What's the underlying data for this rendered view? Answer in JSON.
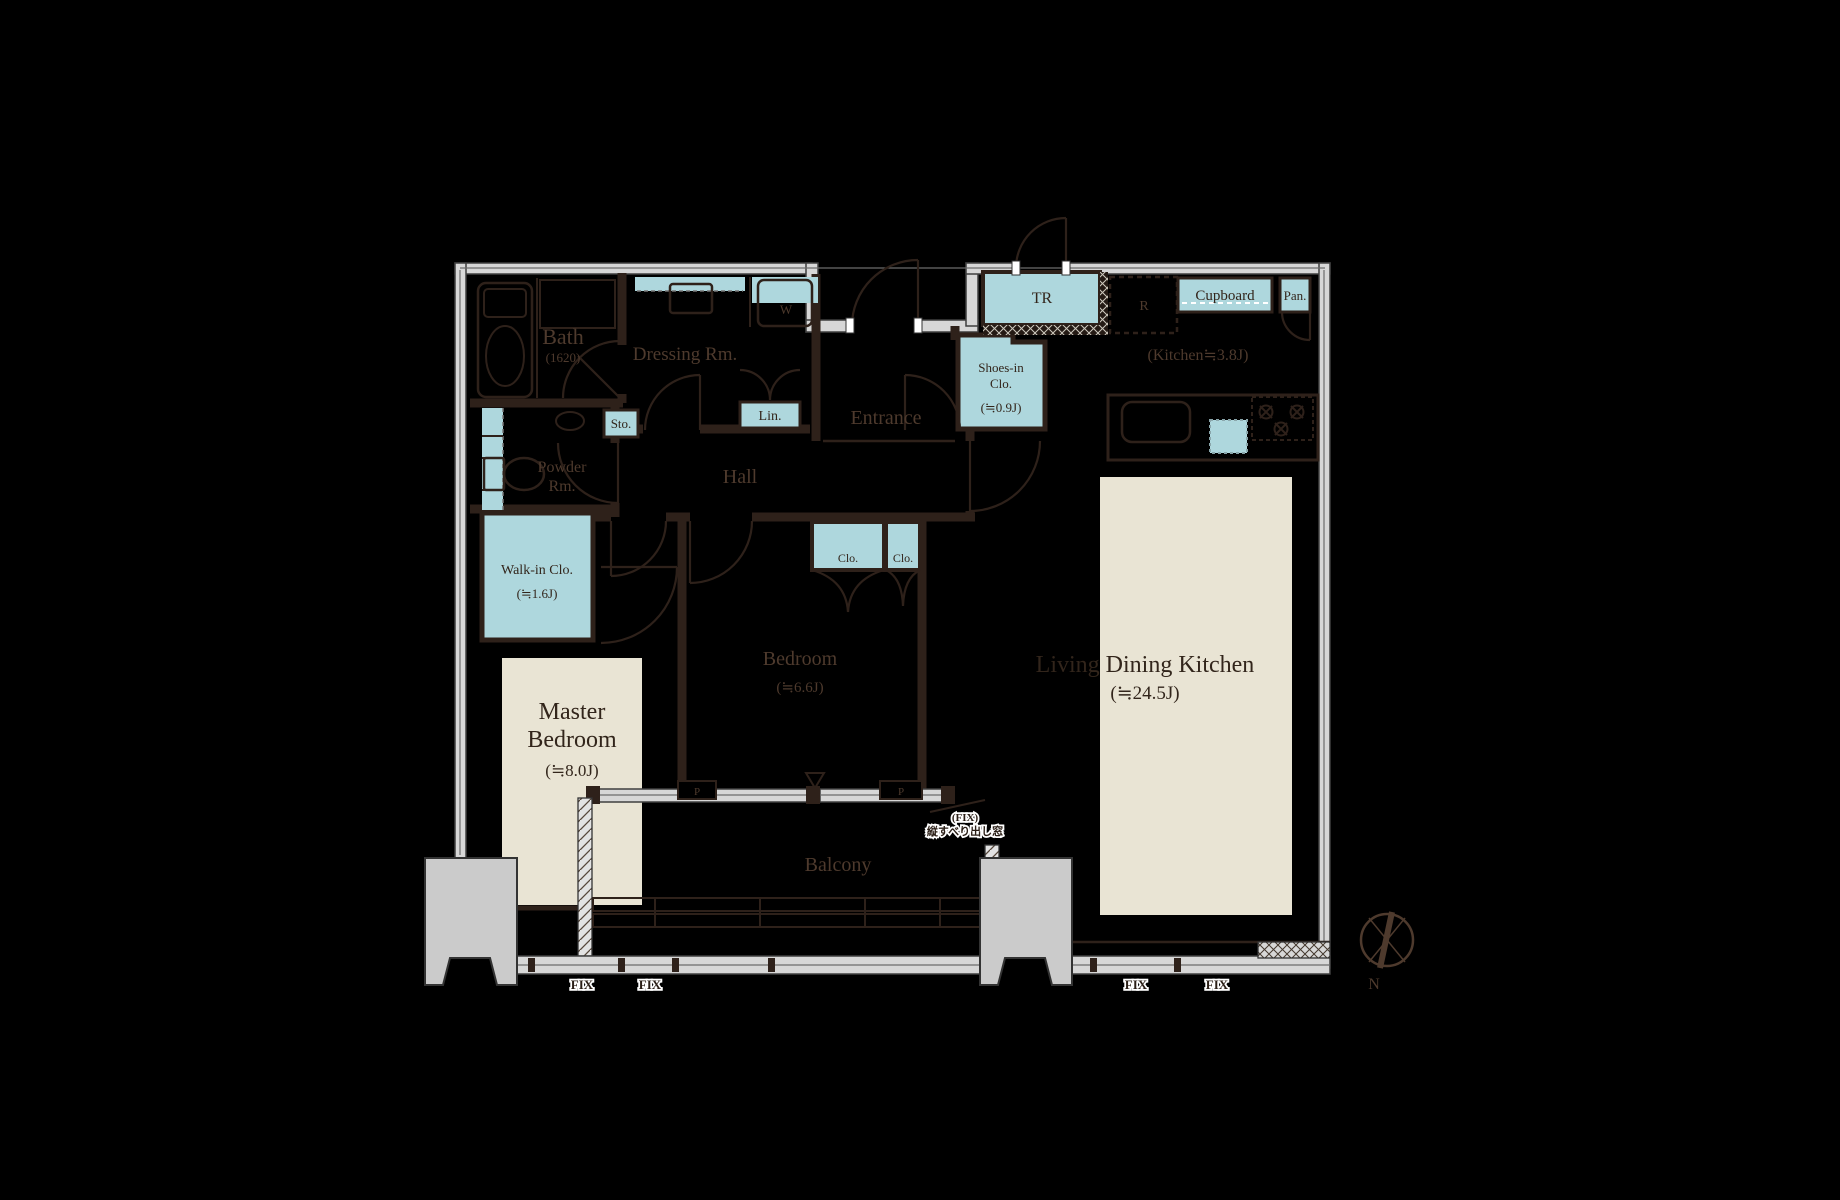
{
  "plan": {
    "colors": {
      "background": "#000000",
      "wall_brown": "#2e211a",
      "window_gray": "#d7d7d7",
      "fixture_blue": "#aed7dd",
      "rug_beige": "#e9e4d4",
      "pillar_gray": "#cbcbcb",
      "label_on_dark": "#4e3a2d",
      "label_on_light": "#32251b"
    },
    "labels": {
      "bath_name": "Bath",
      "bath_size": "(1620)",
      "dressing_room": "Dressing Rm.",
      "washer": "W",
      "entrance": "Entrance",
      "trunk_room": "TR",
      "refrigerator": "R",
      "cupboard": "Cupboard",
      "pantry": "Pan.",
      "kitchen_size": "(Kitchen≒3.8J)",
      "shoes_line1": "Shoes-in",
      "shoes_line2": "Clo.",
      "shoes_size": "(≒0.9J)",
      "storage": "Sto.",
      "linen": "Lin.",
      "powder_line1": "Powder",
      "powder_line2": "Rm.",
      "hall": "Hall",
      "walkin_name": "Walk-in Clo.",
      "walkin_size": "(≒1.6J)",
      "closet_left": "Clo.",
      "closet_right": "Clo.",
      "bedroom_name": "Bedroom",
      "bedroom_size": "(≒6.6J)",
      "master_line1": "Master",
      "master_line2": "Bedroom",
      "master_size": "(≒8.0J)",
      "ldk_name": "Living Dining Kitchen",
      "ldk_size": "(≒24.5J)",
      "balcony": "Balcony",
      "window_note_line1": "(FIX)",
      "window_note_line2": "縦すべり出し窓",
      "fix_1": "FIX",
      "fix_2": "FIX",
      "fix_3": "FIX",
      "fix_4": "FIX",
      "pillar_left": "P",
      "pillar_right": "P",
      "compass_north": "N"
    }
  }
}
